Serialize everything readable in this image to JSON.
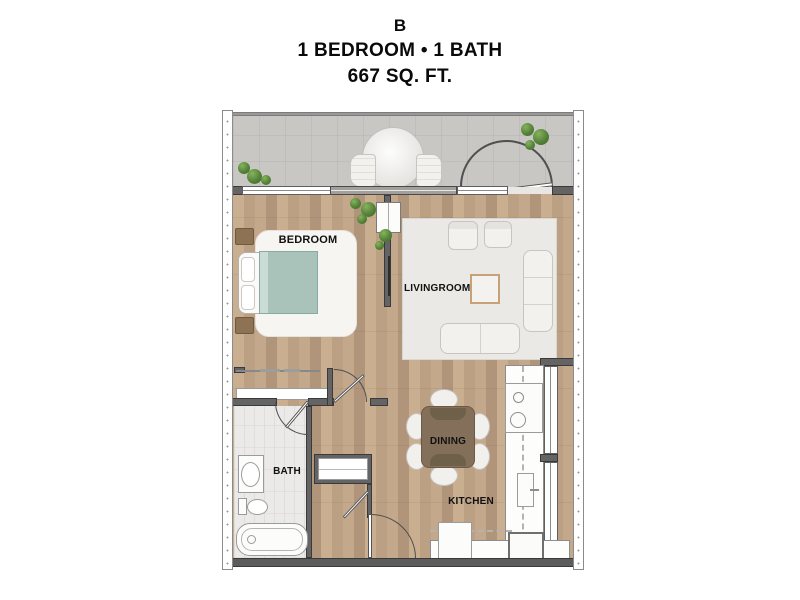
{
  "title": {
    "plan_letter": "B",
    "beds_baths": "1 BEDROOM • 1 BATH",
    "area": "667 SQ. FT."
  },
  "rooms": {
    "bedroom": "BEDROOM",
    "livingroom": "LIVINGROOM",
    "dining": "DINING",
    "bath": "BATH",
    "kitchen": "KITCHEN"
  },
  "colors": {
    "wood_floor": "#c2a689",
    "wood_plank_dark": "#b0957a",
    "balcony_floor": "#c9c7c4",
    "bath_tile": "#eceae8",
    "wall_gray": "#646464",
    "wall_outline": "#3a3a3a",
    "rug_white": "#f7f5f2",
    "rug_living": "#eae9e5",
    "bed_teal": "#a9c3bb",
    "nightstand_brown": "#8d7254",
    "dining_table_brown": "#84705a",
    "fixture_white": "#fcfcfb",
    "plant_green": "#55823a",
    "text_black": "#0a0a0a"
  },
  "features": [
    "patio-round-table",
    "patio-chairs",
    "entry-door",
    "sliding-glass-door",
    "windows",
    "queen-bed",
    "nightstands",
    "bedroom-reach-in-closet",
    "wall-tv",
    "media-cabinet",
    "area-rugs",
    "armchairs",
    "sofa",
    "loveseat",
    "coffee-table",
    "dining-table-6-chairs",
    "range",
    "kitchen-sink",
    "refrigerator",
    "dishwasher",
    "upper-cabinets-dashed",
    "bathroom-vanity",
    "toilet",
    "bathtub",
    "linen-closet",
    "storage-closet",
    "plants"
  ]
}
